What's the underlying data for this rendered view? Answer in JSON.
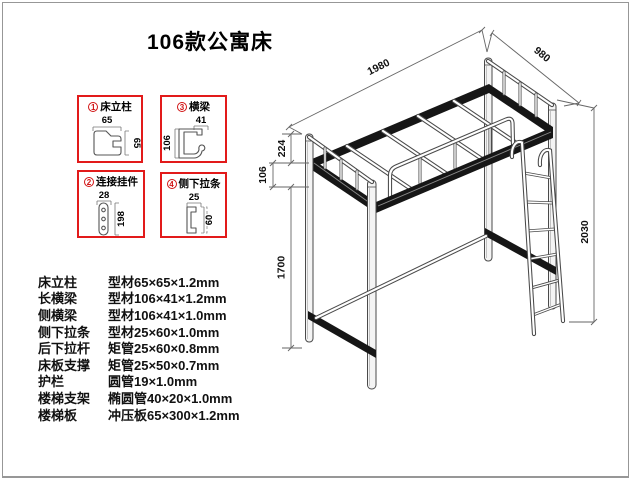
{
  "title": "106款公寓床",
  "detail_boxes": [
    {
      "number": "1",
      "label": "床立柱",
      "dim_top": "65",
      "dim_side": "65"
    },
    {
      "number": "3",
      "label": "横梁",
      "dim_top": "41",
      "dim_side": "106"
    },
    {
      "number": "2",
      "label": "连接挂件",
      "dim_top": "28",
      "dim_side": "198"
    },
    {
      "number": "4",
      "label": "侧下拉条",
      "dim_top": "25",
      "dim_side": "60"
    }
  ],
  "drawing_dimensions": {
    "length": "1980",
    "depth": "980",
    "height": "2030",
    "guard_height": "224",
    "beam_depth": "106",
    "under_clearance": "1700"
  },
  "specs": {
    "rows": [
      {
        "label": "床立柱",
        "value": "型材65×65×1.2mm"
      },
      {
        "label": "长横梁",
        "value": "型材106×41×1.2mm"
      },
      {
        "label": "侧横梁",
        "value": "型材106×41×1.0mm"
      },
      {
        "label": "侧下拉条",
        "value": "型材25×60×1.0mm"
      },
      {
        "label": "后下拉杆",
        "value": "矩管25×60×0.8mm"
      },
      {
        "label": "床板支撑",
        "value": "矩管25×50×0.7mm"
      },
      {
        "label": "护栏",
        "value": "圆管19×1.0mm"
      },
      {
        "label": "楼梯支架",
        "value": "椭圆管40×20×1.0mm"
      },
      {
        "label": "楼梯板",
        "value": "冲压板65×300×1.2mm"
      }
    ]
  },
  "colors": {
    "box_border": "#e21a1a",
    "line": "#4a4a4a",
    "text": "#111111"
  }
}
